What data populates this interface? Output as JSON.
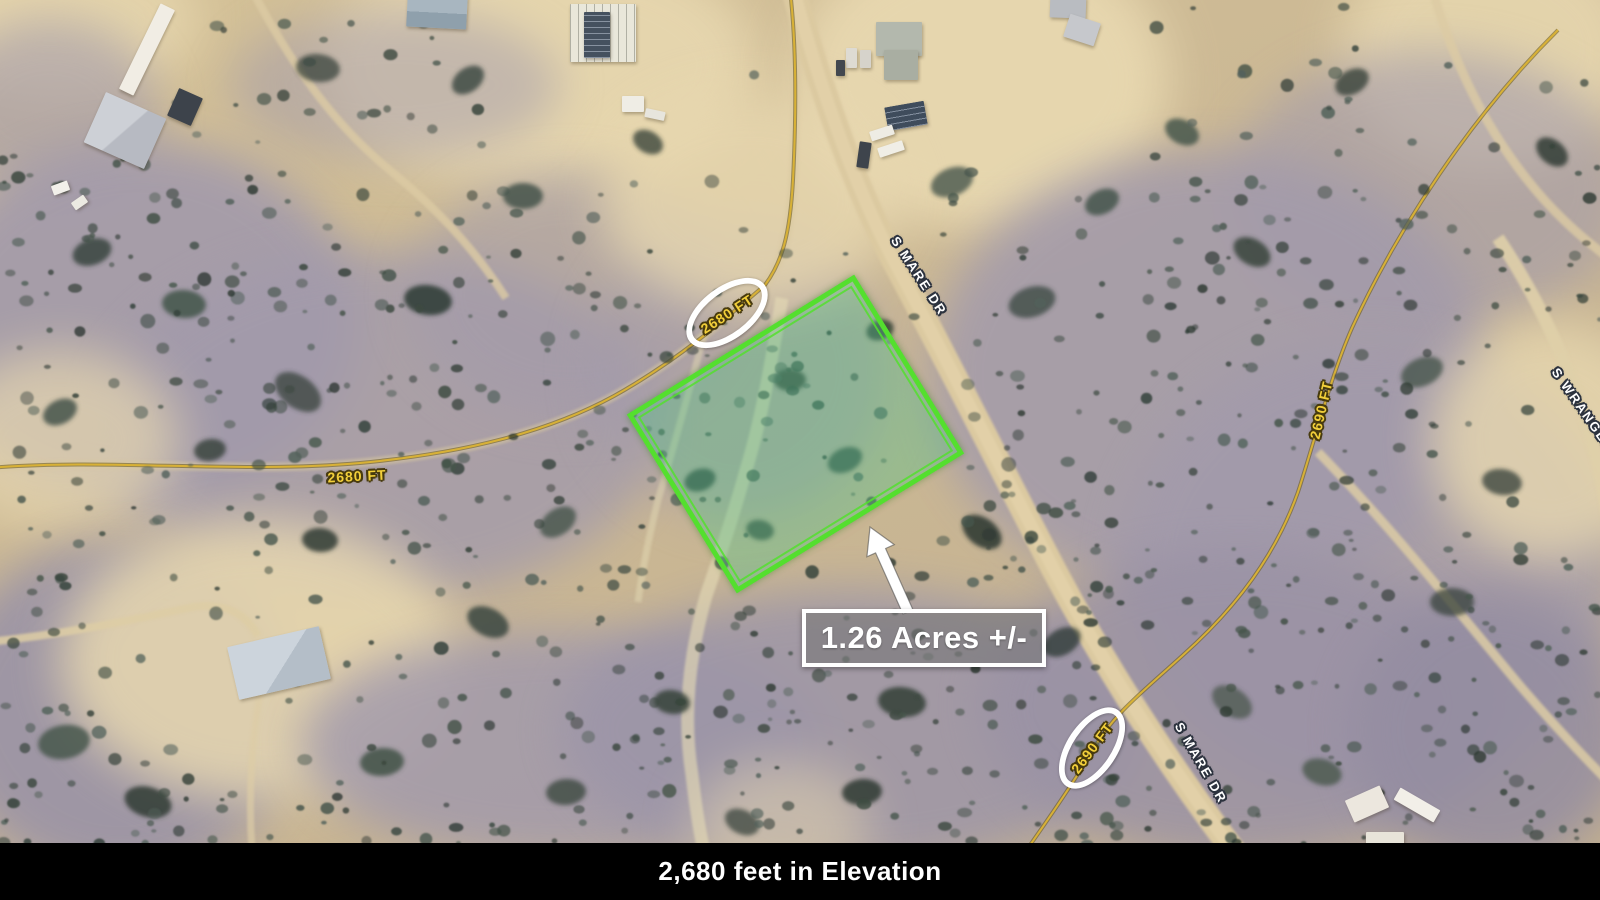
{
  "map_annotations": {
    "acreage_callout": "1.26 Acres +/-",
    "elevation_banner": "2,680 feet in Elevation",
    "road_labels": {
      "s_mare_dr_upper": "S MARE DR",
      "s_mare_dr_lower": "S MARE DR",
      "s_wrangler": "S WRANGLER"
    },
    "contour_labels": {
      "west_2680": "2680 FT",
      "circled_2680": "2680 FT",
      "east_2690": "2690 FT",
      "circled_2690": "2690 FT"
    },
    "colors": {
      "parcel_outline_green": "#54df2e",
      "parcel_fill_green": "rgba(70,195,135,0.35)",
      "contour_yellow": "#f2cf3a",
      "annotation_white": "#ffffff",
      "banner_background": "#000000",
      "banner_text": "#ffffff"
    }
  }
}
